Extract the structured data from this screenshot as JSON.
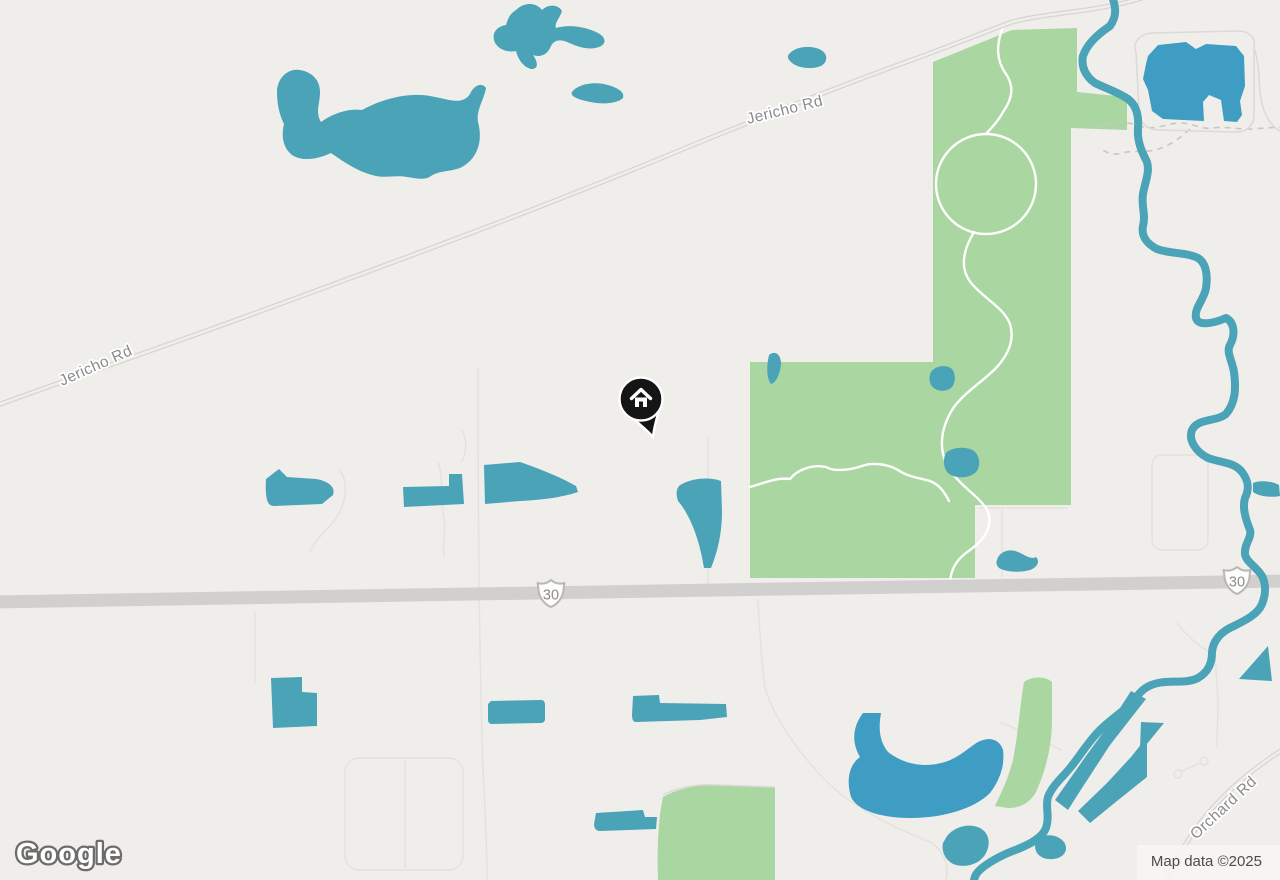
{
  "map": {
    "brand": "Google",
    "attribution": "Map data ©2025",
    "labels": {
      "jericho_west": "Jericho Rd",
      "jericho_east": "Jericho Rd",
      "orchard": "Orchard Rd",
      "route_30": "30"
    },
    "marker": {
      "type": "home"
    },
    "colors": {
      "land": "#f0eeeb",
      "water": "#4aa3b6",
      "water_deep": "#3f9cc3",
      "park": "#a9d6a1",
      "road_major": "#d2d0cf",
      "road_casing": "#d6d4d1",
      "label": "#8a8a8a"
    }
  }
}
